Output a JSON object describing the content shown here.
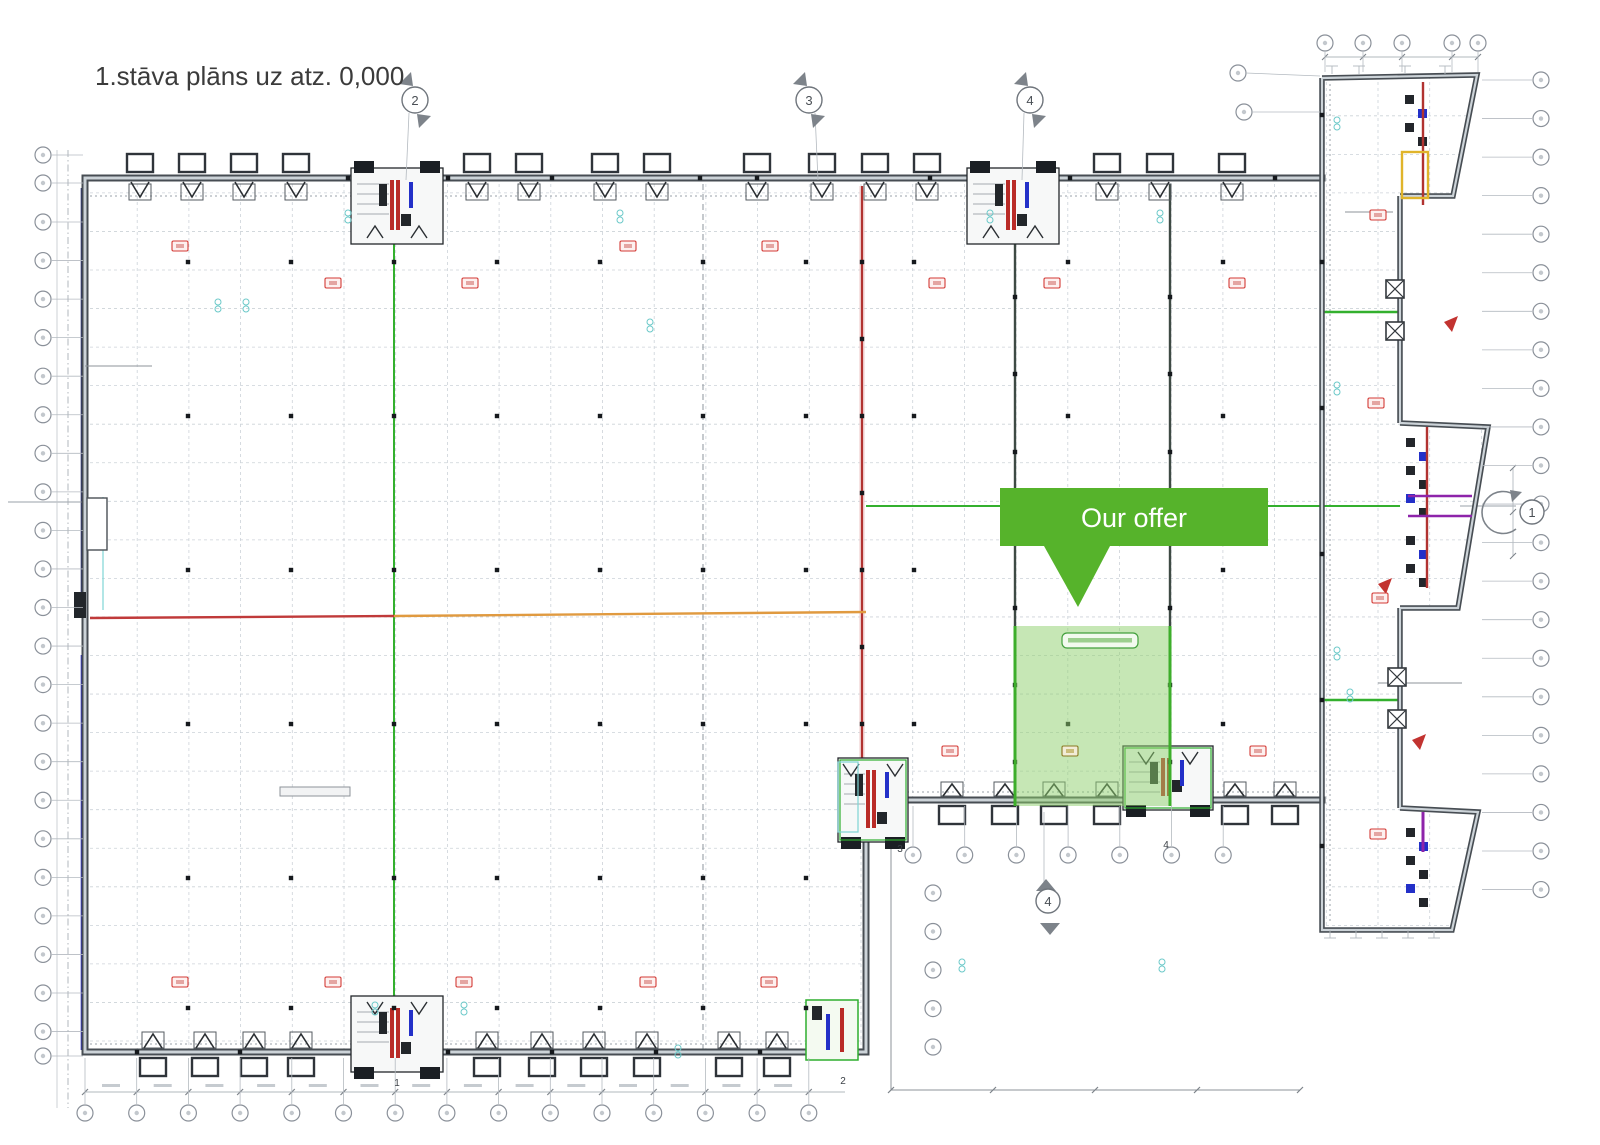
{
  "title": "1.stāva plāns uz atz. 0,000",
  "callout": {
    "label": "Our offer",
    "fill": "#56b32b",
    "text_color": "#ffffff"
  },
  "highlight": {
    "fill": "#8ed06b",
    "border": "#3dae2b"
  },
  "section_markers": {
    "top": [
      {
        "label": "2"
      },
      {
        "label": "3"
      },
      {
        "label": "4"
      }
    ],
    "bottom": [
      {
        "label": "4"
      }
    ],
    "right": [
      {
        "label": "1"
      }
    ]
  },
  "core_labels": [
    {
      "label": "1"
    },
    {
      "label": "2"
    },
    {
      "label": "3"
    },
    {
      "label": "4"
    }
  ],
  "palette": {
    "wall": "#474d53",
    "grid": "#ccd2d8",
    "axis_red": "#b13331",
    "axis_orange": "#e09a40",
    "axis_green": "#33b02e",
    "wall_blue": "#2a2ac0",
    "tag_red": "#d33a35"
  }
}
